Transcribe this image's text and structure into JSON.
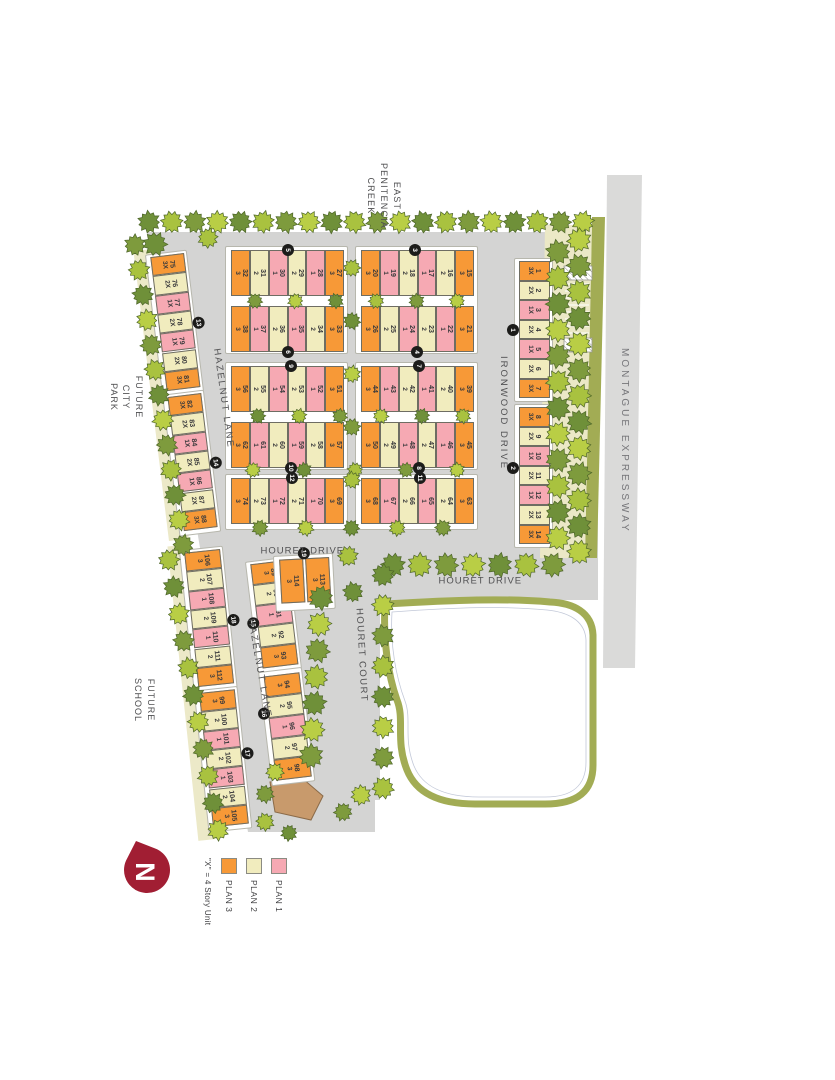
{
  "map": {
    "creek": [
      "EAST",
      "PENITENCIA",
      "CREEK"
    ],
    "expressway": "MONTAGUE EXPRESSWAY",
    "ironwood": "IRONWOOD DRIVE",
    "houret_drive_1": "HOURET DRIVE",
    "houret_drive_2": "HOURET DRIVE",
    "houret_court": "HOURET COURT",
    "hazelnut_1": "HAZELNUT LANE",
    "hazelnut_2": "HAZELNUT LANE",
    "park": [
      "FUTURE",
      "CITY",
      "PARK"
    ],
    "school": [
      "FUTURE",
      "SCHOOL"
    ]
  },
  "north": {
    "label": "N",
    "color": "#a11e33"
  },
  "legend": {
    "items": [
      {
        "label": "PLAN 1",
        "plan": "1",
        "color": "#f6a9b3"
      },
      {
        "label": "PLAN 2",
        "plan": "2",
        "color": "#f1ecbe"
      },
      {
        "label": "PLAN 3",
        "plan": "3",
        "color": "#f79937"
      }
    ],
    "note": "\"X\" = 4 Story Unit"
  },
  "plan_colors": {
    "1": "#f6a9b3",
    "2": "#f1ecbe",
    "3": "#f79937"
  },
  "colors": {
    "road": "#d4d4d3",
    "expressway": "#dadad9",
    "olive": "#a2ac54",
    "buffer": "#ebe8c6",
    "cream_edge": "#ece9c8",
    "rec_building": "#c89a6c",
    "tree_greens": [
      "#b9ce45",
      "#7e9b3d",
      "#a9c23f",
      "#6f9039"
    ],
    "badge": "#1c1c1a"
  },
  "buildings": [
    {
      "badge": "1",
      "units": [
        [
          1,
          "3X"
        ],
        [
          2,
          "2X"
        ],
        [
          3,
          "1X"
        ],
        [
          4,
          "2X"
        ],
        [
          5,
          "1X"
        ],
        [
          6,
          "2X"
        ],
        [
          7,
          "3X"
        ]
      ]
    },
    {
      "badge": "2",
      "units": [
        [
          8,
          "3X"
        ],
        [
          9,
          "2X"
        ],
        [
          10,
          "1X"
        ],
        [
          11,
          "2X"
        ],
        [
          12,
          "1X"
        ],
        [
          13,
          "2X"
        ],
        [
          14,
          "3X"
        ]
      ]
    },
    {
      "badge": "3",
      "units": [
        [
          15,
          "3"
        ],
        [
          16,
          "2"
        ],
        [
          17,
          "1"
        ],
        [
          18,
          "2"
        ],
        [
          19,
          "1"
        ],
        [
          20,
          "3"
        ]
      ]
    },
    {
      "badge": "4",
      "units": [
        [
          21,
          "3"
        ],
        [
          22,
          "1"
        ],
        [
          23,
          "2"
        ],
        [
          24,
          "1"
        ],
        [
          25,
          "2"
        ],
        [
          26,
          "3"
        ]
      ]
    },
    {
      "badge": "5",
      "units": [
        [
          27,
          "3"
        ],
        [
          28,
          "1"
        ],
        [
          29,
          "2"
        ],
        [
          30,
          "1"
        ],
        [
          31,
          "2"
        ],
        [
          32,
          "3"
        ]
      ]
    },
    {
      "badge": "6",
      "units": [
        [
          33,
          "3"
        ],
        [
          34,
          "2"
        ],
        [
          35,
          "1"
        ],
        [
          36,
          "2"
        ],
        [
          37,
          "1"
        ],
        [
          38,
          "3"
        ]
      ]
    },
    {
      "badge": "7",
      "units": [
        [
          39,
          "3"
        ],
        [
          40,
          "2"
        ],
        [
          41,
          "1"
        ],
        [
          42,
          "2"
        ],
        [
          43,
          "1"
        ],
        [
          44,
          "3"
        ]
      ]
    },
    {
      "badge": "8",
      "units": [
        [
          45,
          "3"
        ],
        [
          46,
          "1"
        ],
        [
          47,
          "2"
        ],
        [
          48,
          "1"
        ],
        [
          49,
          "2"
        ],
        [
          50,
          "3"
        ]
      ]
    },
    {
      "badge": "9",
      "units": [
        [
          51,
          "3"
        ],
        [
          52,
          "1"
        ],
        [
          53,
          "2"
        ],
        [
          54,
          "1"
        ],
        [
          55,
          "2"
        ],
        [
          56,
          "3"
        ]
      ]
    },
    {
      "badge": "10",
      "units": [
        [
          57,
          "3"
        ],
        [
          58,
          "2"
        ],
        [
          59,
          "1"
        ],
        [
          60,
          "2"
        ],
        [
          61,
          "1"
        ],
        [
          62,
          "3"
        ]
      ]
    },
    {
      "badge": "11",
      "units": [
        [
          63,
          "3"
        ],
        [
          64,
          "2"
        ],
        [
          65,
          "1"
        ],
        [
          66,
          "2"
        ],
        [
          67,
          "1"
        ],
        [
          68,
          "3"
        ]
      ]
    },
    {
      "badge": "12",
      "units": [
        [
          69,
          "3"
        ],
        [
          70,
          "1"
        ],
        [
          71,
          "2"
        ],
        [
          72,
          "1"
        ],
        [
          73,
          "2"
        ],
        [
          74,
          "3"
        ]
      ]
    },
    {
      "badge": "13",
      "units": [
        [
          75,
          "3X"
        ],
        [
          76,
          "2X"
        ],
        [
          77,
          "1X"
        ],
        [
          78,
          "2X"
        ],
        [
          79,
          "1X"
        ],
        [
          80,
          "2X"
        ],
        [
          81,
          "3X"
        ]
      ]
    },
    {
      "badge": "14",
      "units": [
        [
          82,
          "3X"
        ],
        [
          83,
          "2X"
        ],
        [
          84,
          "1X"
        ],
        [
          85,
          "2X"
        ],
        [
          86,
          "1X"
        ],
        [
          87,
          "2X"
        ],
        [
          88,
          "3X"
        ]
      ]
    },
    {
      "badge": "15",
      "units": [
        [
          89,
          "3"
        ],
        [
          90,
          "2"
        ],
        [
          91,
          "1"
        ],
        [
          92,
          "2"
        ],
        [
          93,
          "3"
        ]
      ]
    },
    {
      "badge": "16",
      "units": [
        [
          94,
          "3"
        ],
        [
          95,
          "2"
        ],
        [
          96,
          "1"
        ],
        [
          97,
          "2"
        ],
        [
          98,
          "3"
        ]
      ]
    },
    {
      "badge": "17",
      "units": [
        [
          99,
          "3"
        ],
        [
          100,
          "2"
        ],
        [
          101,
          "1"
        ],
        [
          102,
          "2"
        ],
        [
          103,
          "1"
        ],
        [
          104,
          "2"
        ],
        [
          105,
          "3"
        ]
      ]
    },
    {
      "badge": "18",
      "units": [
        [
          106,
          "3"
        ],
        [
          107,
          "2"
        ],
        [
          108,
          "1"
        ],
        [
          109,
          "2"
        ],
        [
          110,
          "1"
        ],
        [
          111,
          "2"
        ],
        [
          112,
          "3"
        ]
      ]
    },
    {
      "badge": "19",
      "units": [
        [
          113,
          "3"
        ],
        [
          114,
          "3"
        ]
      ]
    }
  ]
}
